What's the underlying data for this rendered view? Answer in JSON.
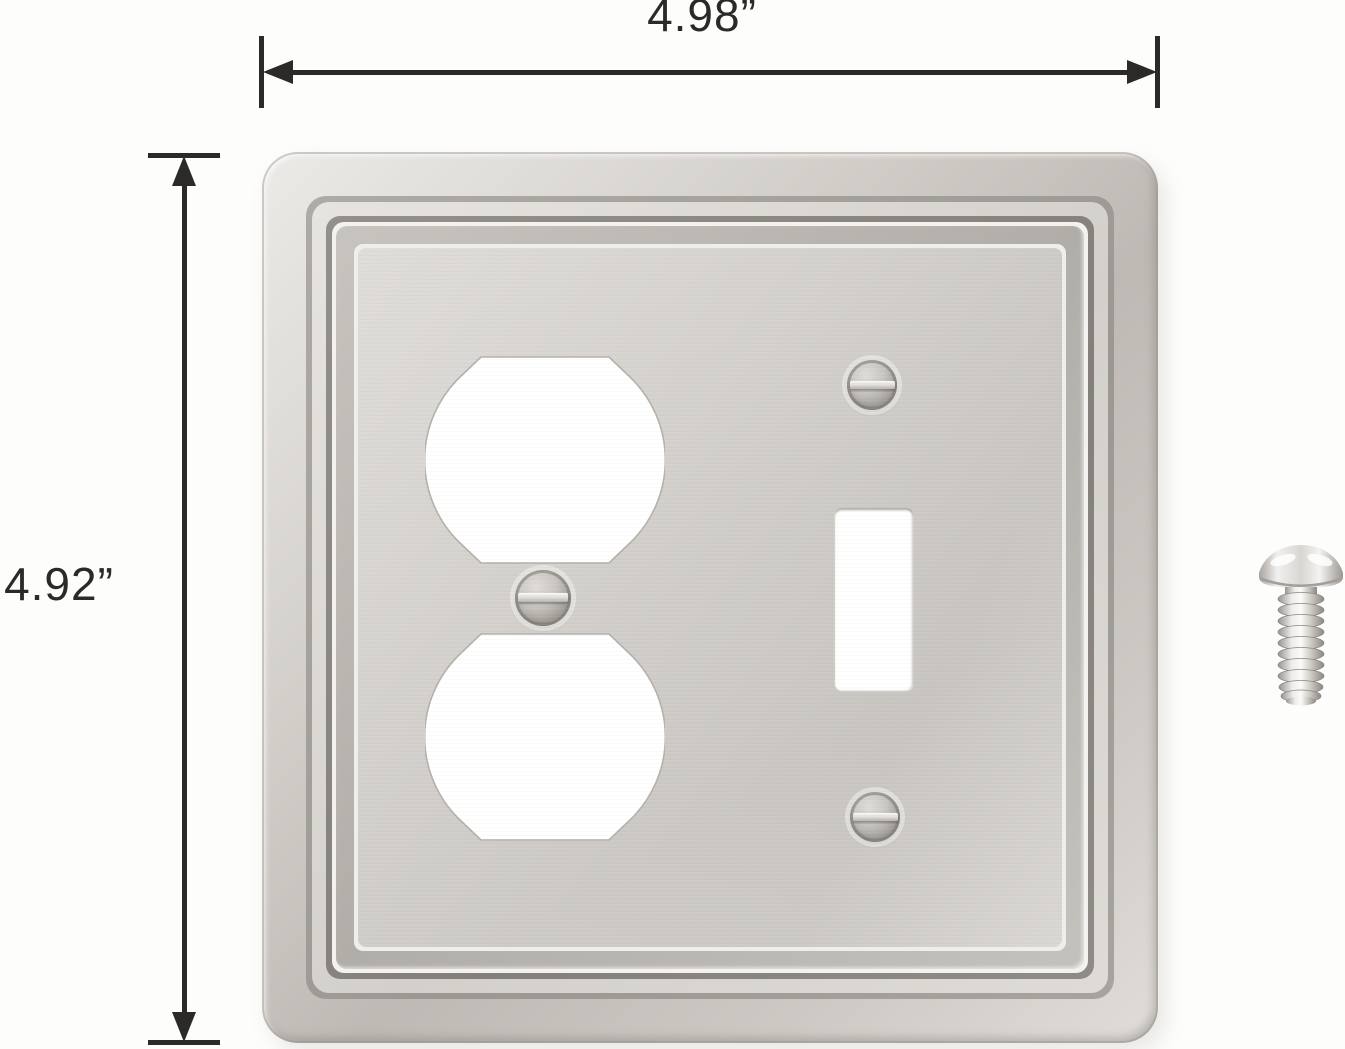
{
  "diagram": {
    "width_label": "4.98”",
    "height_label": "4.92”"
  },
  "product": {
    "item": "two-gang-wall-plate",
    "openings": [
      "duplex-outlet-opening-top",
      "duplex-outlet-opening-bottom",
      "toggle-switch-opening"
    ],
    "fasteners": [
      "toggle-top-screw",
      "toggle-bottom-screw",
      "duplex-center-screw",
      "loose-mounting-screw"
    ]
  },
  "colors": {
    "background": "#fdfdfb",
    "annotation_ink": "#2b2a28",
    "plate_face": "#d4d1cd",
    "plate_highlight": "#f3f2ef",
    "plate_ridge_dark": "#8a8681",
    "opening_fill": "#ffffff",
    "screw_metal": "#c9c6c1"
  }
}
